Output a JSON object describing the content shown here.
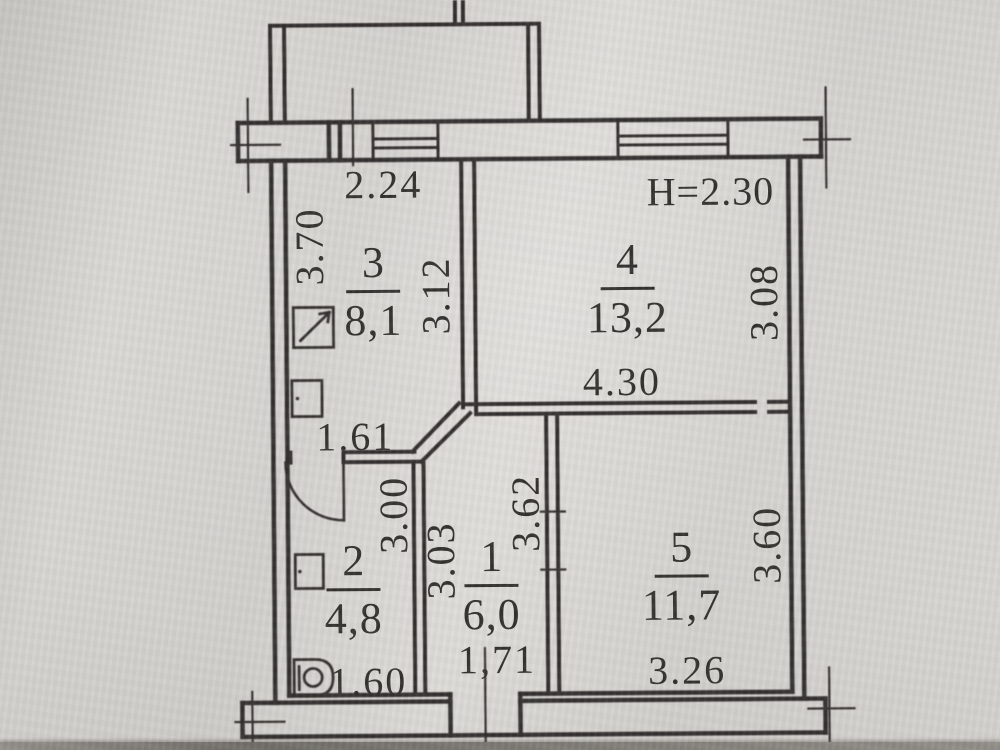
{
  "plan": {
    "title": "apartment-floor-plan",
    "height_note": "H=2.30",
    "rooms": [
      {
        "number": "1",
        "area": "6,0"
      },
      {
        "number": "2",
        "area": "4,8"
      },
      {
        "number": "3",
        "area": "8,1"
      },
      {
        "number": "4",
        "area": "13,2"
      },
      {
        "number": "5",
        "area": "11,7"
      }
    ],
    "dimensions": {
      "room3_top_width": "2.24",
      "room3_left_height": "3.70",
      "room3_right_height": "3.12",
      "room3_bottom_width": "1.61",
      "room4_right_height": "3.08",
      "room4_bottom_width": "4.30",
      "room1_left_height": "3.03",
      "room1_right_height": "3.62",
      "room1_bottom_width": "1,71",
      "room2_right_height": "3.00",
      "room2_bottom_width": "1.60",
      "room5_right_height": "3.60",
      "room5_bottom_width": "3.26"
    }
  }
}
